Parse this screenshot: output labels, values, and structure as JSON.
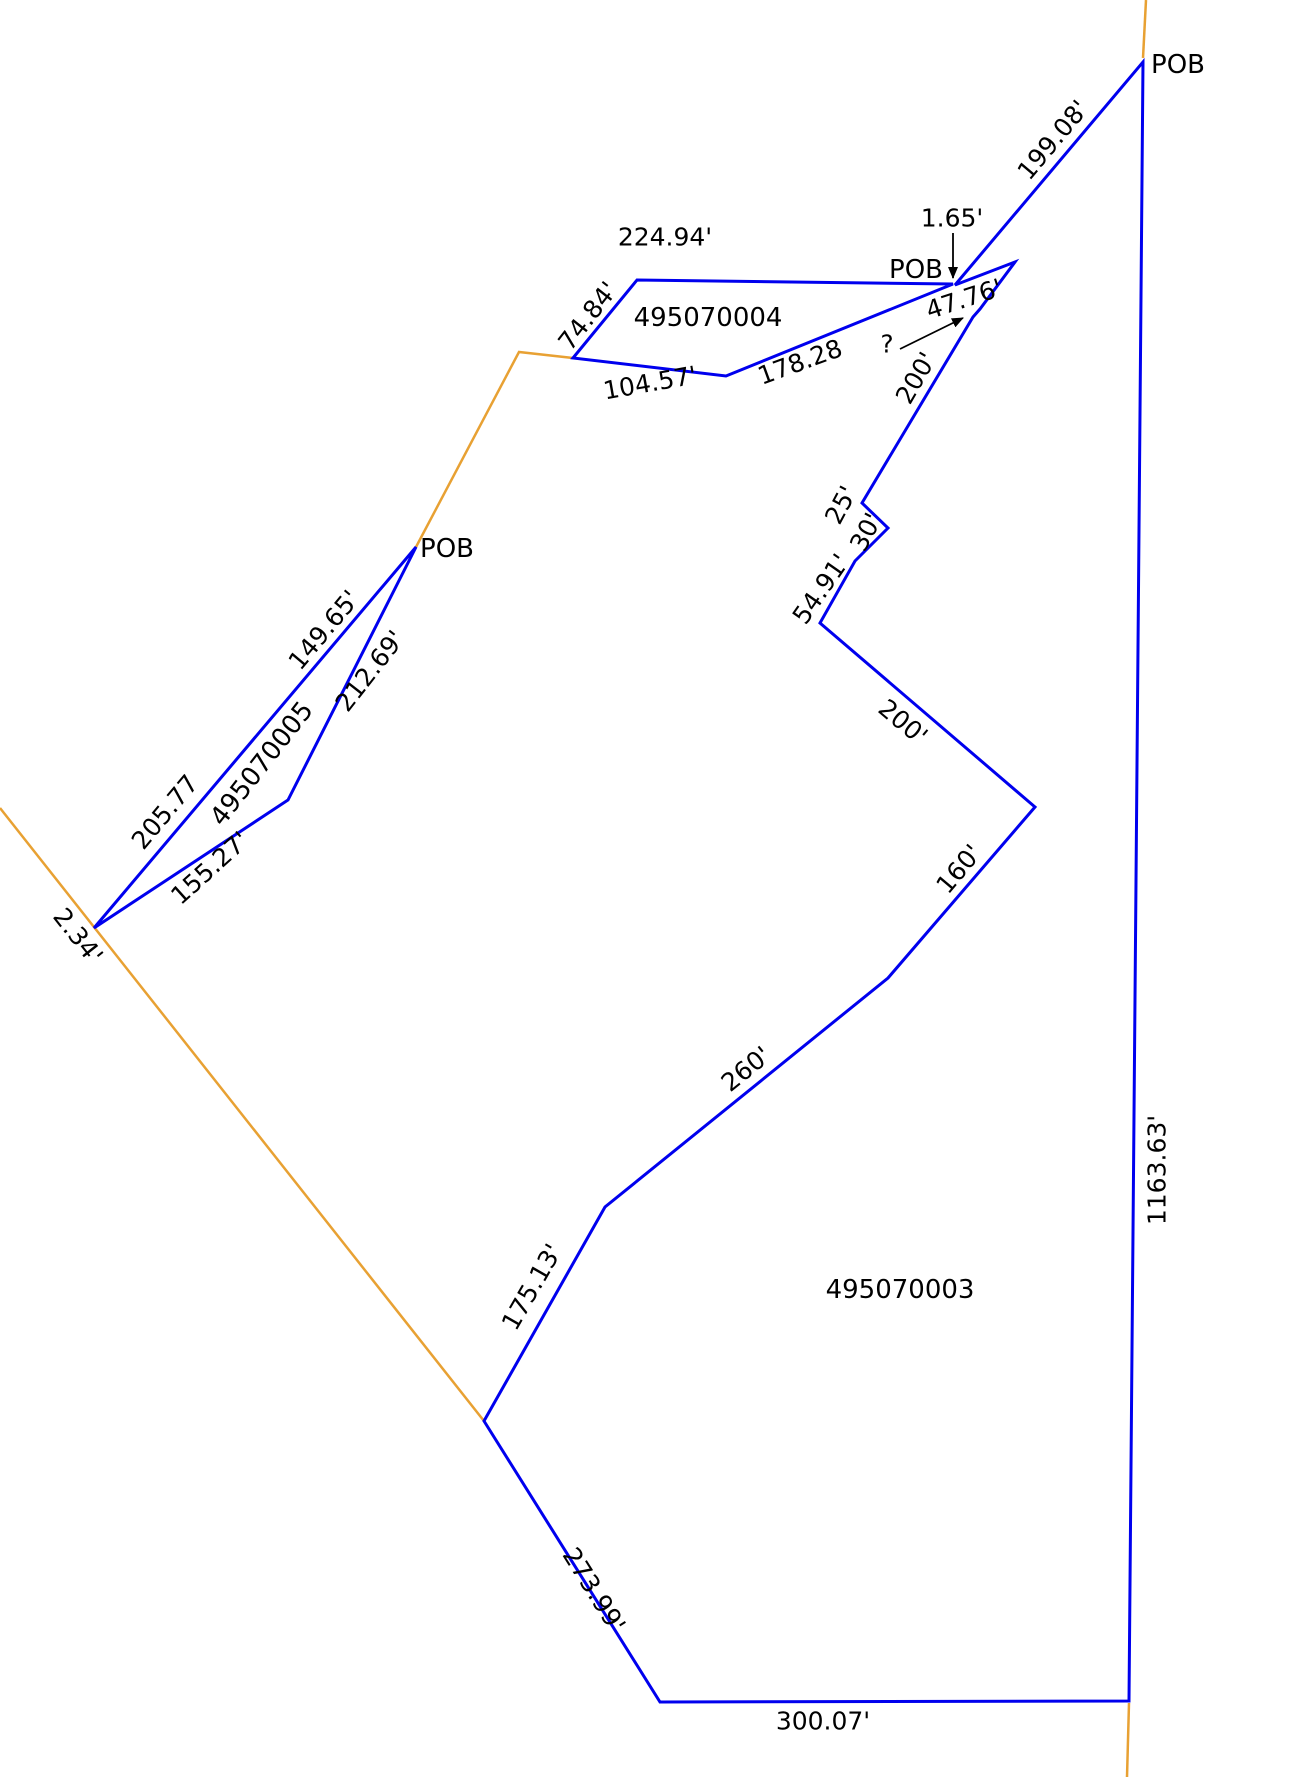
{
  "page": {
    "background": "#ffffff",
    "description": "Survey plat diagram showing three parcel boundaries with dimension call-outs"
  },
  "diagram": {
    "width": 1291,
    "height": 1777,
    "colors": {
      "parcel_line": "#0000EE",
      "adjoiner_line": "#E8A133",
      "text": "#000000",
      "arrow": "#000000"
    },
    "parcels": [
      {
        "apn": "495070004",
        "points": [
          [
            637,
            280
          ],
          [
            953,
            284
          ],
          [
            726,
            376
          ],
          [
            573,
            358
          ]
        ]
      },
      {
        "apn": "495070005",
        "points": [
          [
            416,
            547
          ],
          [
            288,
            800
          ],
          [
            94,
            928
          ]
        ]
      },
      {
        "apn": "495070003",
        "points": [
          [
            1143,
            62
          ],
          [
            1129,
            1701
          ],
          [
            660,
            1702
          ],
          [
            484,
            1421
          ],
          [
            605,
            1207
          ],
          [
            888,
            978
          ],
          [
            1035,
            807
          ],
          [
            820,
            623
          ],
          [
            855,
            561
          ],
          [
            888,
            528
          ],
          [
            862,
            503
          ],
          [
            973,
            317
          ],
          [
            980,
            309
          ],
          [
            1015,
            262
          ],
          [
            955,
            285
          ]
        ]
      }
    ],
    "adjoiner_lines": [
      {
        "points": [
          [
            1146,
            0
          ],
          [
            1143,
            58
          ]
        ]
      },
      {
        "points": [
          [
            1129,
            1703
          ],
          [
            1127,
            1777
          ]
        ]
      },
      {
        "points": [
          [
            0,
            808
          ],
          [
            484,
            1421
          ]
        ]
      },
      {
        "points": [
          [
            416,
            547
          ],
          [
            519,
            352
          ],
          [
            573,
            358
          ]
        ]
      }
    ],
    "labels": [
      {
        "kind": "pob",
        "text": "POB",
        "x": 1178,
        "y": 65,
        "rot": 0,
        "size": 26
      },
      {
        "kind": "dimension",
        "text": "199.08'",
        "x": 1053,
        "y": 140,
        "rot": -50,
        "size": 25
      },
      {
        "kind": "dimension",
        "text": "1.65'",
        "x": 952,
        "y": 218,
        "rot": 0,
        "size": 25
      },
      {
        "kind": "pob",
        "text": "POB",
        "x": 916,
        "y": 270,
        "rot": 0,
        "size": 26
      },
      {
        "kind": "dimension",
        "text": "224.94'",
        "x": 665,
        "y": 237,
        "rot": 0,
        "size": 25
      },
      {
        "kind": "parcel-id",
        "text": "495070004",
        "x": 708,
        "y": 318,
        "rot": 0,
        "size": 26
      },
      {
        "kind": "dimension",
        "text": "74.84'",
        "x": 588,
        "y": 316,
        "rot": -52,
        "size": 25
      },
      {
        "kind": "dimension",
        "text": "104.57'",
        "x": 650,
        "y": 383,
        "rot": -10,
        "size": 25
      },
      {
        "kind": "dimension",
        "text": "178.28",
        "x": 800,
        "y": 362,
        "rot": -20,
        "size": 25
      },
      {
        "kind": "dimension",
        "text": "47.76'",
        "x": 964,
        "y": 299,
        "rot": -18,
        "size": 25
      },
      {
        "kind": "dimension",
        "text": "?",
        "x": 887,
        "y": 344,
        "rot": 0,
        "size": 25
      },
      {
        "kind": "dimension",
        "text": "200'",
        "x": 916,
        "y": 378,
        "rot": -60,
        "size": 25
      },
      {
        "kind": "dimension",
        "text": "25'",
        "x": 841,
        "y": 505,
        "rot": -62,
        "size": 25
      },
      {
        "kind": "dimension",
        "text": "30'",
        "x": 866,
        "y": 532,
        "rot": -62,
        "size": 25
      },
      {
        "kind": "dimension",
        "text": "54.91'",
        "x": 821,
        "y": 589,
        "rot": -55,
        "size": 25
      },
      {
        "kind": "dimension",
        "text": "200'",
        "x": 903,
        "y": 722,
        "rot": 40,
        "size": 25
      },
      {
        "kind": "dimension",
        "text": "160'",
        "x": 959,
        "y": 869,
        "rot": -50,
        "size": 25
      },
      {
        "kind": "dimension",
        "text": "260'",
        "x": 746,
        "y": 1069,
        "rot": -39,
        "size": 25
      },
      {
        "kind": "dimension",
        "text": "175.13'",
        "x": 532,
        "y": 1287,
        "rot": -60,
        "size": 25
      },
      {
        "kind": "dimension",
        "text": "273.99'",
        "x": 594,
        "y": 1590,
        "rot": 58,
        "size": 25
      },
      {
        "kind": "dimension",
        "text": "300.07'",
        "x": 823,
        "y": 1721,
        "rot": 0,
        "size": 25
      },
      {
        "kind": "dimension",
        "text": "1163.63'",
        "x": 1157,
        "y": 1170,
        "rot": -90,
        "size": 25
      },
      {
        "kind": "parcel-id",
        "text": "495070003",
        "x": 900,
        "y": 1290,
        "rot": 0,
        "size": 26
      },
      {
        "kind": "pob",
        "text": "POB",
        "x": 447,
        "y": 549,
        "rot": 0,
        "size": 26
      },
      {
        "kind": "dimension",
        "text": "149.65'",
        "x": 324,
        "y": 630,
        "rot": -50,
        "size": 25
      },
      {
        "kind": "dimension",
        "text": "212.69'",
        "x": 370,
        "y": 671,
        "rot": -52,
        "size": 25
      },
      {
        "kind": "parcel-id",
        "text": "495070005",
        "x": 262,
        "y": 764,
        "rot": -52,
        "size": 26
      },
      {
        "kind": "dimension",
        "text": "205.77",
        "x": 165,
        "y": 812,
        "rot": -50,
        "size": 25
      },
      {
        "kind": "dimension",
        "text": "155.27'",
        "x": 210,
        "y": 868,
        "rot": -42,
        "size": 25
      },
      {
        "kind": "dimension",
        "text": "2.34'",
        "x": 78,
        "y": 936,
        "rot": 52,
        "size": 25
      }
    ],
    "arrows": [
      {
        "name": "arrow-to-pob-1-65",
        "from": [
          953,
          233
        ],
        "to": [
          953,
          278
        ]
      },
      {
        "name": "arrow-to-unknown-gap",
        "from": [
          900,
          349
        ],
        "to": [
          963,
          318
        ]
      }
    ]
  }
}
